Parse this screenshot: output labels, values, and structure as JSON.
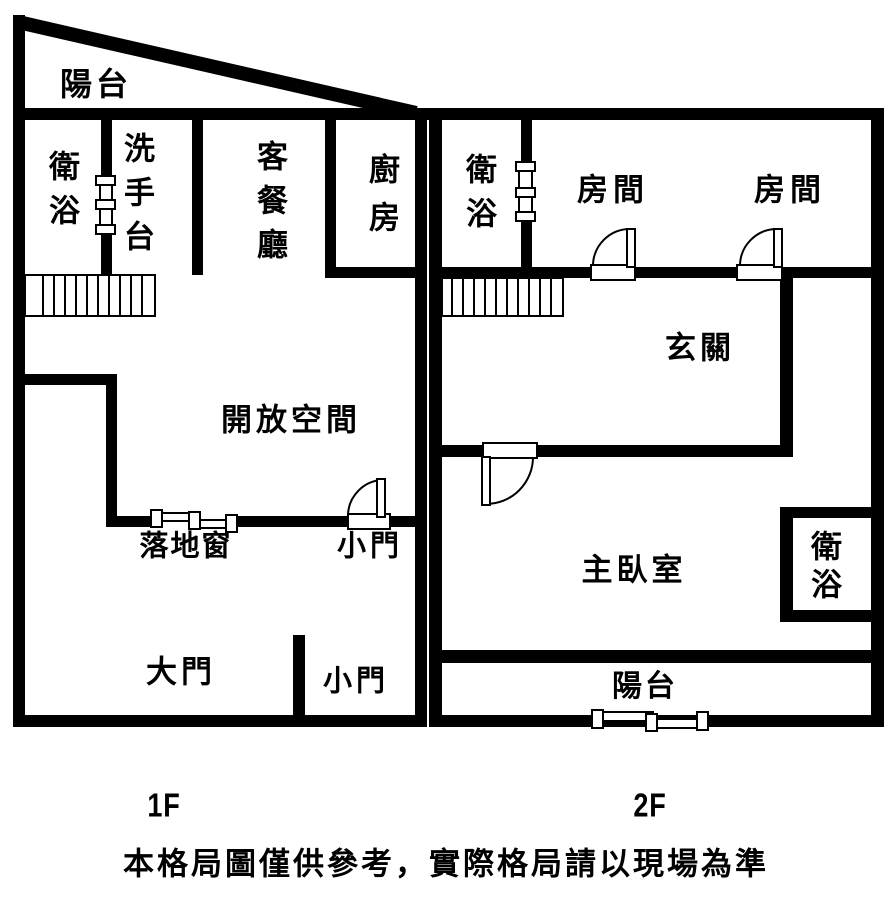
{
  "canvas": {
    "background": "#ffffff",
    "line_color": "#000000"
  },
  "floor1": {
    "label": "1F",
    "balcony": "陽台",
    "bathroom": "衛浴",
    "washbasin": "洗手台",
    "living_dining": "客餐廳",
    "kitchen": "廚房",
    "open_space": "開放空間",
    "floor_window": "落地窗",
    "small_door_upper": "小門",
    "main_door": "大門",
    "small_door_lower": "小門"
  },
  "floor2": {
    "label": "2F",
    "bathroom_upper": "衛浴",
    "room_left": "房間",
    "room_right": "房間",
    "entry_hall": "玄關",
    "master_bedroom": "主臥室",
    "bathroom_lower": "衛浴",
    "balcony": "陽台"
  },
  "footer": {
    "disclaimer": "本格局圖僅供參考，實際格局請以現場為準"
  }
}
